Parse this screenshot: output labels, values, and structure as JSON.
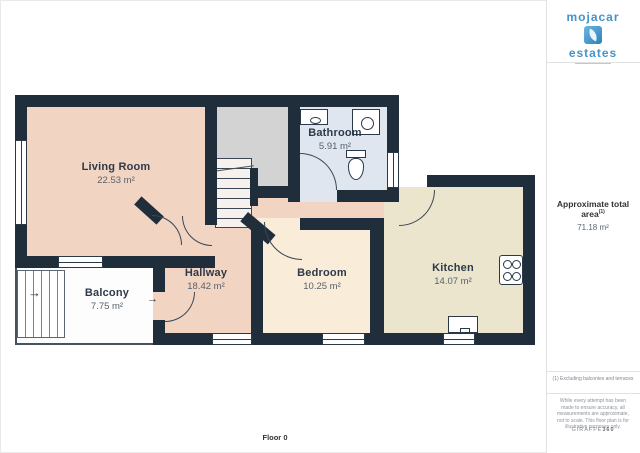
{
  "branding": {
    "logo_top": "mojacar",
    "logo_bottom": "estates",
    "watermark_main": "GIRAFFE",
    "watermark_suffix": "360"
  },
  "summary": {
    "title": "Approximate total area",
    "superscript": "(1)",
    "value": "71.18 m²"
  },
  "footnote": "(1) Excluding balconies and terraces",
  "disclaimer": "While every attempt has been made to ensure accuracy, all measurements are approximate, not to scale. This floor plan is for illustrative purposes only.",
  "floor_label": "Floor 0",
  "rooms": [
    {
      "name": "Living Room",
      "area": "22.53 m²"
    },
    {
      "name": "Balcony",
      "area": "7.75 m²"
    },
    {
      "name": "Hallway",
      "area": "18.42 m²"
    },
    {
      "name": "Bathroom",
      "area": "5.91 m²"
    },
    {
      "name": "Bedroom",
      "area": "10.25 m²"
    },
    {
      "name": "Kitchen",
      "area": "14.07 m²"
    }
  ],
  "icons": {
    "arrow_right": "→"
  },
  "colors": {
    "wall": "#202e3c",
    "living_hallway": "#f2d4c2",
    "bedroom": "#f9ecd9",
    "kitchen": "#ebe5cd",
    "bathroom": "#dfe6ef",
    "stairwell": "#d3d3d4",
    "balcony": "#fdfdfd",
    "logo_blue": "#4494cb"
  }
}
